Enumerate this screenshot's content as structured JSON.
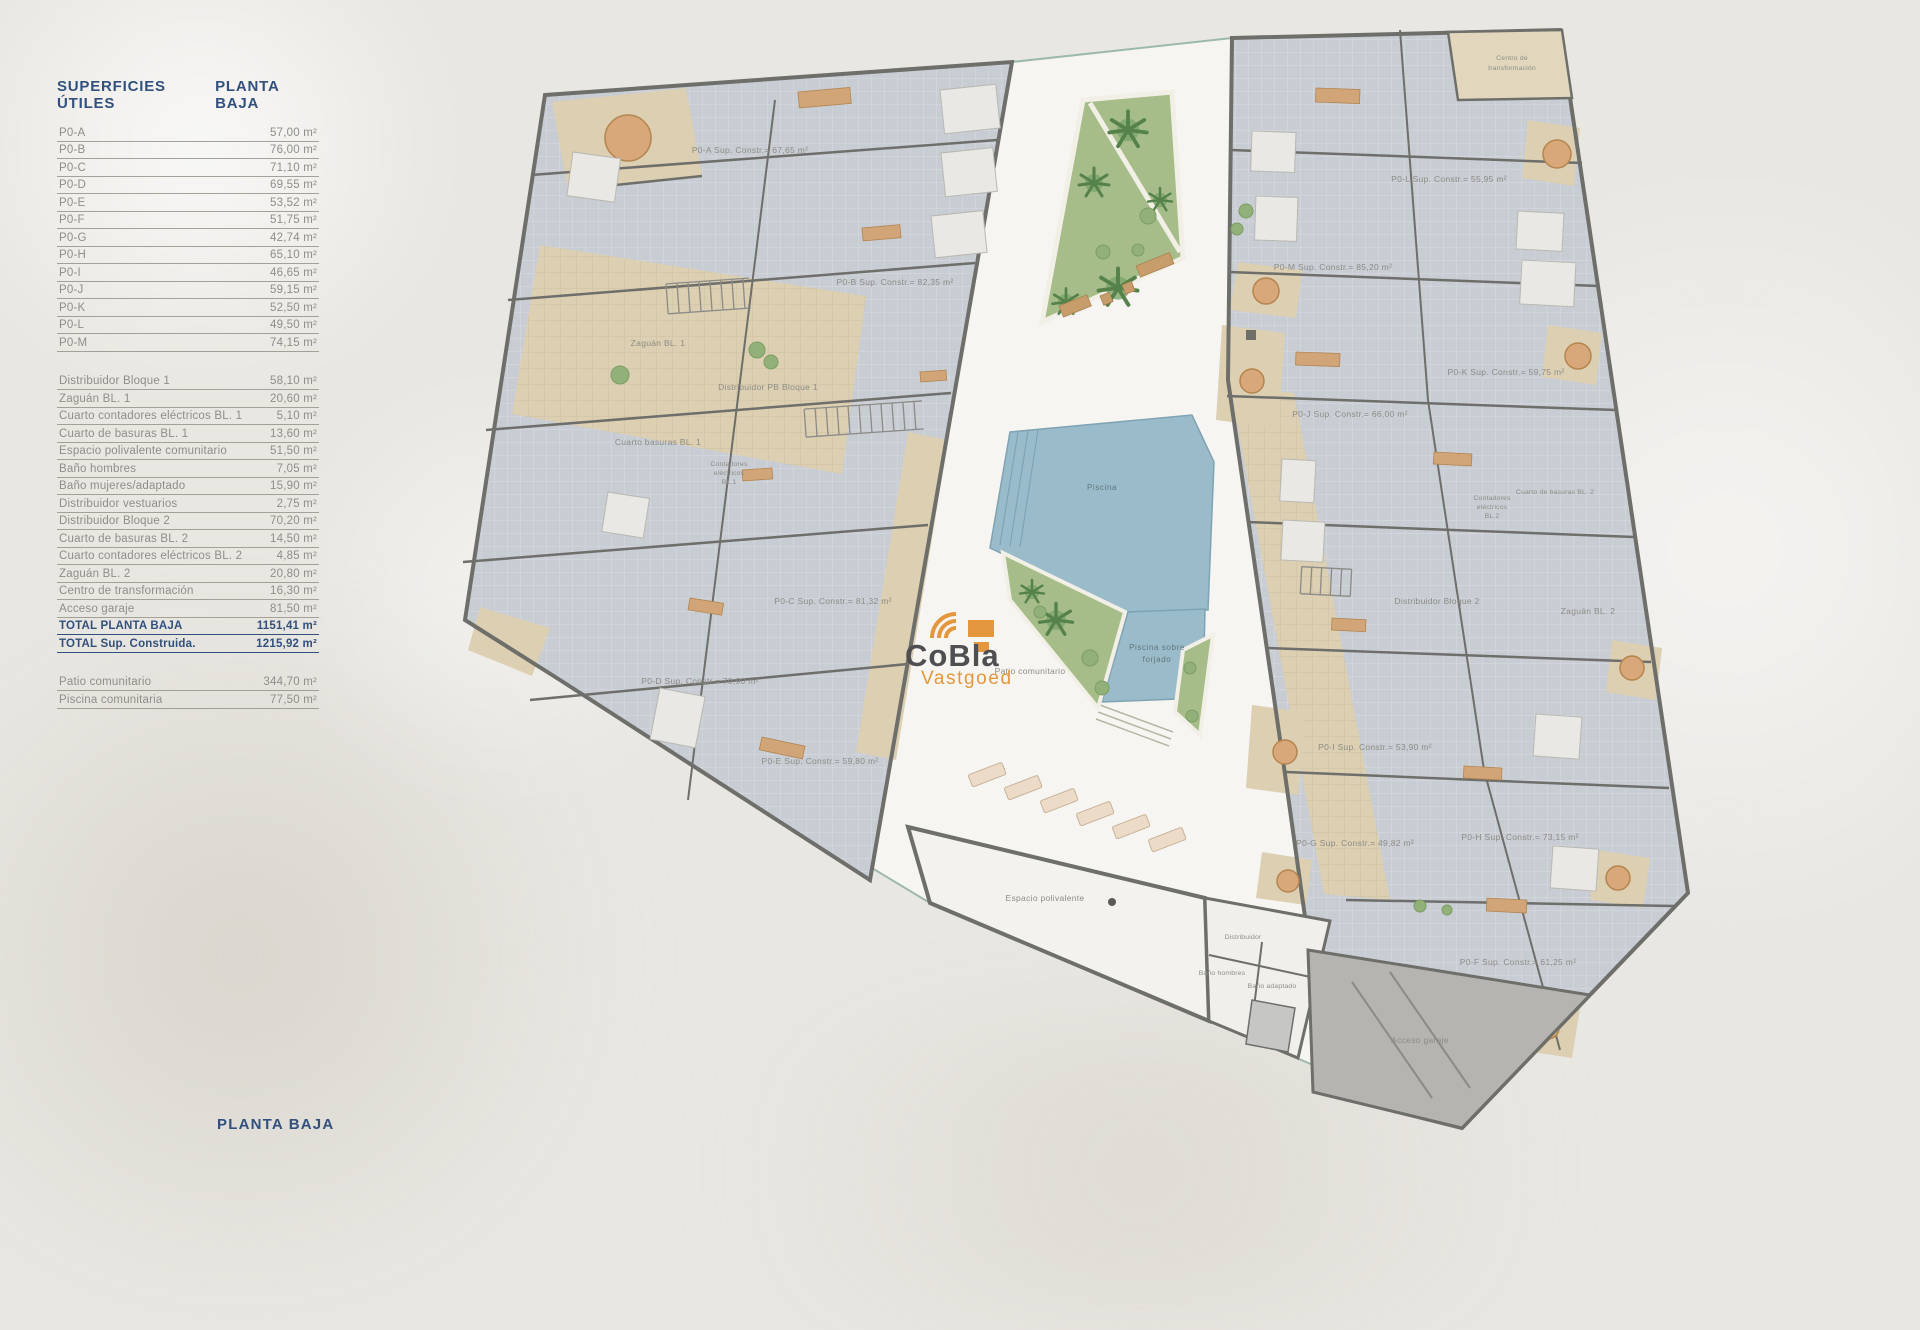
{
  "page": {
    "bottom_title": "PLANTA BAJA"
  },
  "table": {
    "header_left": "SUPERFICIES ÚTILES",
    "header_right": "PLANTA BAJA",
    "units": [
      {
        "label": "P0-A",
        "value": "57,00 m²"
      },
      {
        "label": "P0-B",
        "value": "76,00 m²"
      },
      {
        "label": "P0-C",
        "value": "71,10 m²"
      },
      {
        "label": "P0-D",
        "value": "69,55 m²"
      },
      {
        "label": "P0-E",
        "value": "53,52 m²"
      },
      {
        "label": "P0-F",
        "value": "51,75 m²"
      },
      {
        "label": "P0-G",
        "value": "42,74 m²"
      },
      {
        "label": "P0-H",
        "value": "65,10 m²"
      },
      {
        "label": "P0-I",
        "value": "46,65 m²"
      },
      {
        "label": "P0-J",
        "value": "59,15 m²"
      },
      {
        "label": "P0-K",
        "value": "52,50 m²"
      },
      {
        "label": "P0-L",
        "value": "49,50 m²"
      },
      {
        "label": "P0-M",
        "value": "74,15 m²"
      }
    ],
    "common": [
      {
        "label": "Distribuidor Bloque 1",
        "value": "58,10 m²"
      },
      {
        "label": "Zaguán BL. 1",
        "value": "20,60 m²"
      },
      {
        "label": "Cuarto contadores eléctricos BL. 1",
        "value": "5,10 m²"
      },
      {
        "label": "Cuarto de basuras BL. 1",
        "value": "13,60 m²"
      },
      {
        "label": "Espacio polivalente comunitario",
        "value": "51,50 m²"
      },
      {
        "label": "Baño hombres",
        "value": "7,05 m²"
      },
      {
        "label": "Baño mujeres/adaptado",
        "value": "15,90 m²"
      },
      {
        "label": "Distribuidor vestuarios",
        "value": "2,75 m²"
      },
      {
        "label": "Distribuidor Bloque 2",
        "value": "70,20 m²"
      },
      {
        "label": "Cuarto de basuras BL. 2",
        "value": "14,50 m²"
      },
      {
        "label": "Cuarto contadores eléctricos BL. 2",
        "value": "4,85 m²"
      },
      {
        "label": "Zaguán BL. 2",
        "value": "20,80 m²"
      },
      {
        "label": "Centro de transformación",
        "value": "16,30 m²"
      },
      {
        "label": "Acceso garaje",
        "value": "81,50 m²"
      }
    ],
    "totals": [
      {
        "label": "TOTAL PLANTA BAJA",
        "value": "1151,41 m²"
      },
      {
        "label": "TOTAL Sup. Construida.",
        "value": "1215,92 m²"
      }
    ],
    "outdoor": [
      {
        "label": "Patio comunitario",
        "value": "344,70 m²"
      },
      {
        "label": "Piscina comunitaria",
        "value": "77,50 m²"
      }
    ]
  },
  "plan": {
    "watermark": {
      "brand": "CoBla",
      "sub": "Vastgoed"
    },
    "labels": {
      "p0a": "P0-A Sup. Constr.= 67,65 m²",
      "p0b": "P0-B Sup. Constr.= 82,35 m²",
      "p0c": "P0-C Sup. Constr.= 81,32 m²",
      "p0d": "P0-D Sup. Constr.= 70,90 m²",
      "p0e": "P0-E Sup. Constr.= 59,80 m²",
      "p0f": "P0-F Sup. Constr.= 61,25 m²",
      "p0g": "P0-G Sup. Constr.= 49,82 m²",
      "p0h": "P0-H Sup. Constr.= 73,15 m²",
      "p0i": "P0-I Sup. Constr.= 53,90 m²",
      "p0j": "P0-J Sup. Constr.= 66,00 m²",
      "p0k": "P0-K Sup. Constr.= 59,75 m²",
      "p0l": "P0-L Sup. Constr.= 55,95 m²",
      "p0m": "P0-M Sup. Constr.= 85,20 m²",
      "zaguan1": "Zaguán BL. 1",
      "distribuidor1": "Distribuidor PB Bloque 1",
      "basuras1": "Cuarto basuras BL. 1",
      "contadores1_l1": "Contadores",
      "contadores1_l2": "eléctricos",
      "contadores1_l3": "BL.1",
      "zaguan2": "Zaguán BL. 2",
      "distribuidor2": "Distribuidor Bloque 2",
      "basuras2": "Cuarto de basuras BL. 2",
      "contadores2_l1": "Contadores",
      "contadores2_l2": "eléctricos",
      "contadores2_l3": "BL.2",
      "centro_l1": "Centro de",
      "centro_l2": "transformación",
      "piscina": "Piscina",
      "piscina_forjado_l1": "Piscina sobre",
      "piscina_forjado_l2": "forjado",
      "patio": "Patio comunitario",
      "espacio": "Espacio polivalente",
      "distribuidor": "Distribuidor",
      "bano_hombres": "Baño hombres",
      "bano_adaptado": "Baño adaptado",
      "acceso": "Acceso garaje"
    },
    "colors": {
      "navy": "#32507d",
      "label_gray": "#8d8d86",
      "wall": "#6e6e6a",
      "room_gray": "#c8ccd3",
      "paving_tan": "#dccfb2",
      "pool_blue": "#9abcca",
      "garden_green": "#a6bd89",
      "garage_gray": "#b6b4b0",
      "logo_orange": "#e4973d",
      "logo_gray": "#4f4f52"
    }
  }
}
